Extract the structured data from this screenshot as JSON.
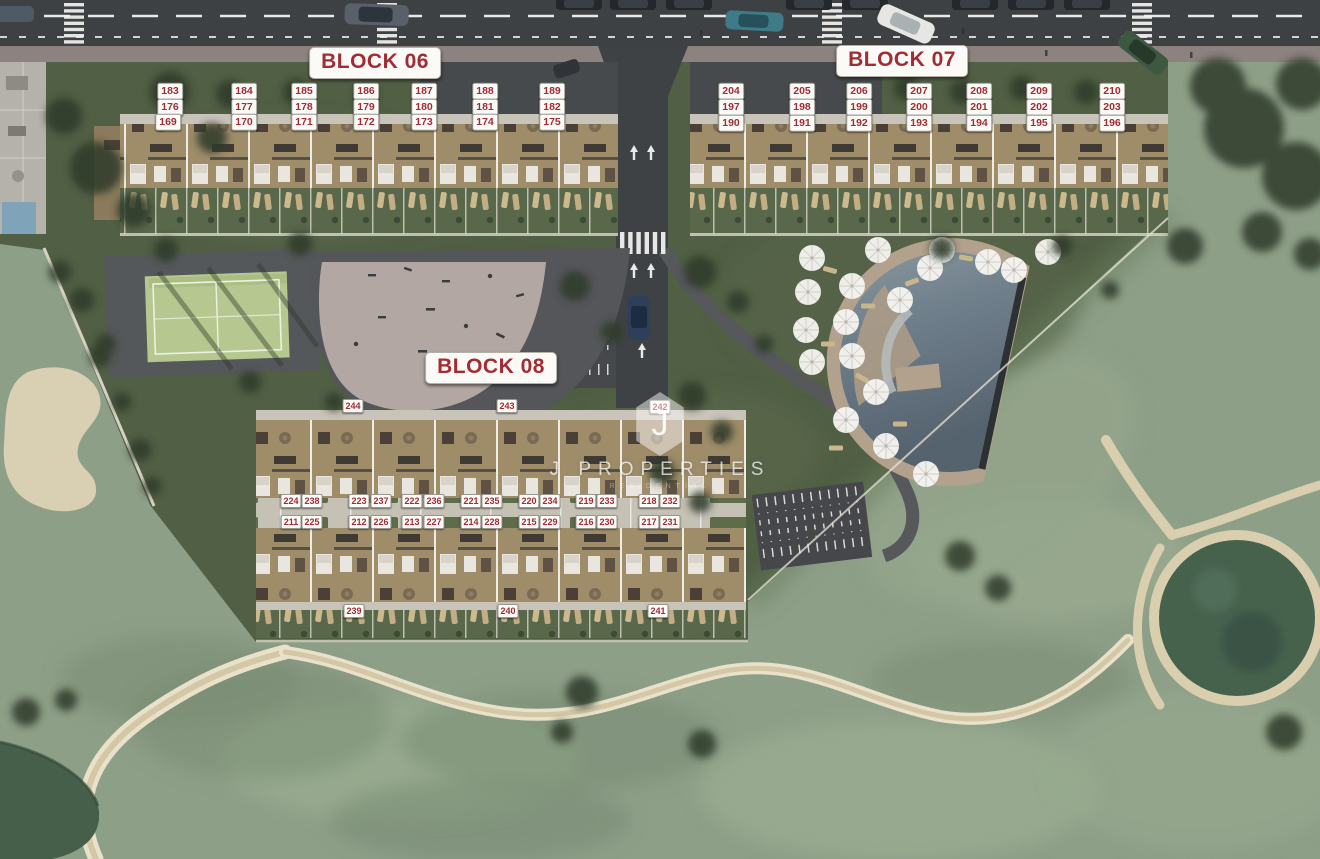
{
  "watermark": {
    "logo_letter": "J",
    "brand": "J PROPERTIES",
    "subtitle": "RESIDENTIAL"
  },
  "colors": {
    "label_red": "#A22C33",
    "label_bg": "#FCFBF8",
    "road_asphalt": "#3E4144",
    "development_green": "#515F44",
    "golf_green": "#8E9F88",
    "sand": "#D8CCAA",
    "pond_water": "#46624D",
    "pool_water": "#6E7E8A",
    "court_green": "#B6C890",
    "building_tan": "#A3906F",
    "walkway_gray": "#C9C4BA"
  },
  "map": {
    "block_labels": [
      {
        "id": "block-06",
        "text": "BLOCK 06",
        "x": 375,
        "y": 63
      },
      {
        "id": "block-07",
        "text": "BLOCK 07",
        "x": 902,
        "y": 61
      },
      {
        "id": "block-08",
        "text": "BLOCK 08",
        "x": 491,
        "y": 368
      }
    ],
    "unit_labels": [
      {
        "t": "183",
        "x": 170,
        "y": 91,
        "b": 6
      },
      {
        "t": "184",
        "x": 244,
        "y": 91,
        "b": 6
      },
      {
        "t": "185",
        "x": 304,
        "y": 91,
        "b": 6
      },
      {
        "t": "186",
        "x": 366,
        "y": 91,
        "b": 6
      },
      {
        "t": "187",
        "x": 424,
        "y": 91,
        "b": 6
      },
      {
        "t": "188",
        "x": 485,
        "y": 91,
        "b": 6
      },
      {
        "t": "189",
        "x": 552,
        "y": 91,
        "b": 6
      },
      {
        "t": "176",
        "x": 170,
        "y": 107,
        "b": 6
      },
      {
        "t": "177",
        "x": 244,
        "y": 107,
        "b": 6
      },
      {
        "t": "178",
        "x": 304,
        "y": 107,
        "b": 6
      },
      {
        "t": "179",
        "x": 366,
        "y": 107,
        "b": 6
      },
      {
        "t": "180",
        "x": 424,
        "y": 107,
        "b": 6
      },
      {
        "t": "181",
        "x": 485,
        "y": 107,
        "b": 6
      },
      {
        "t": "182",
        "x": 552,
        "y": 107,
        "b": 6
      },
      {
        "t": "169",
        "x": 168,
        "y": 122,
        "b": 6
      },
      {
        "t": "170",
        "x": 244,
        "y": 122,
        "b": 6
      },
      {
        "t": "171",
        "x": 304,
        "y": 122,
        "b": 6
      },
      {
        "t": "172",
        "x": 366,
        "y": 122,
        "b": 6
      },
      {
        "t": "173",
        "x": 424,
        "y": 122,
        "b": 6
      },
      {
        "t": "174",
        "x": 485,
        "y": 122,
        "b": 6
      },
      {
        "t": "175",
        "x": 552,
        "y": 122,
        "b": 6
      },
      {
        "t": "204",
        "x": 731,
        "y": 91,
        "b": 7
      },
      {
        "t": "205",
        "x": 802,
        "y": 91,
        "b": 7
      },
      {
        "t": "206",
        "x": 859,
        "y": 91,
        "b": 7
      },
      {
        "t": "207",
        "x": 919,
        "y": 91,
        "b": 7
      },
      {
        "t": "208",
        "x": 979,
        "y": 91,
        "b": 7
      },
      {
        "t": "209",
        "x": 1039,
        "y": 91,
        "b": 7
      },
      {
        "t": "210",
        "x": 1112,
        "y": 91,
        "b": 7
      },
      {
        "t": "197",
        "x": 731,
        "y": 107,
        "b": 7
      },
      {
        "t": "198",
        "x": 802,
        "y": 107,
        "b": 7
      },
      {
        "t": "199",
        "x": 859,
        "y": 107,
        "b": 7
      },
      {
        "t": "200",
        "x": 919,
        "y": 107,
        "b": 7
      },
      {
        "t": "201",
        "x": 979,
        "y": 107,
        "b": 7
      },
      {
        "t": "202",
        "x": 1039,
        "y": 107,
        "b": 7
      },
      {
        "t": "203",
        "x": 1112,
        "y": 107,
        "b": 7
      },
      {
        "t": "190",
        "x": 731,
        "y": 123,
        "b": 7
      },
      {
        "t": "191",
        "x": 802,
        "y": 123,
        "b": 7
      },
      {
        "t": "192",
        "x": 859,
        "y": 123,
        "b": 7
      },
      {
        "t": "193",
        "x": 919,
        "y": 123,
        "b": 7
      },
      {
        "t": "194",
        "x": 979,
        "y": 123,
        "b": 7
      },
      {
        "t": "195",
        "x": 1039,
        "y": 123,
        "b": 7
      },
      {
        "t": "196",
        "x": 1112,
        "y": 123,
        "b": 7
      },
      {
        "t": "244",
        "x": 353,
        "y": 406,
        "b": 8
      },
      {
        "t": "243",
        "x": 507,
        "y": 406,
        "b": 8
      },
      {
        "t": "242",
        "x": 660,
        "y": 407,
        "b": 8
      },
      {
        "t": "224",
        "x": 291,
        "y": 501,
        "b": 8
      },
      {
        "t": "238",
        "x": 312,
        "y": 501,
        "b": 8
      },
      {
        "t": "223",
        "x": 359,
        "y": 501,
        "b": 8
      },
      {
        "t": "237",
        "x": 381,
        "y": 501,
        "b": 8
      },
      {
        "t": "222",
        "x": 412,
        "y": 501,
        "b": 8
      },
      {
        "t": "236",
        "x": 434,
        "y": 501,
        "b": 8
      },
      {
        "t": "221",
        "x": 471,
        "y": 501,
        "b": 8
      },
      {
        "t": "235",
        "x": 492,
        "y": 501,
        "b": 8
      },
      {
        "t": "220",
        "x": 529,
        "y": 501,
        "b": 8
      },
      {
        "t": "234",
        "x": 550,
        "y": 501,
        "b": 8
      },
      {
        "t": "219",
        "x": 586,
        "y": 501,
        "b": 8
      },
      {
        "t": "233",
        "x": 607,
        "y": 501,
        "b": 8
      },
      {
        "t": "218",
        "x": 649,
        "y": 501,
        "b": 8
      },
      {
        "t": "232",
        "x": 670,
        "y": 501,
        "b": 8
      },
      {
        "t": "211",
        "x": 291,
        "y": 522,
        "b": 8
      },
      {
        "t": "225",
        "x": 312,
        "y": 522,
        "b": 8
      },
      {
        "t": "212",
        "x": 359,
        "y": 522,
        "b": 8
      },
      {
        "t": "226",
        "x": 381,
        "y": 522,
        "b": 8
      },
      {
        "t": "213",
        "x": 412,
        "y": 522,
        "b": 8
      },
      {
        "t": "227",
        "x": 434,
        "y": 522,
        "b": 8
      },
      {
        "t": "214",
        "x": 471,
        "y": 522,
        "b": 8
      },
      {
        "t": "228",
        "x": 492,
        "y": 522,
        "b": 8
      },
      {
        "t": "215",
        "x": 529,
        "y": 522,
        "b": 8
      },
      {
        "t": "229",
        "x": 550,
        "y": 522,
        "b": 8
      },
      {
        "t": "216",
        "x": 586,
        "y": 522,
        "b": 8
      },
      {
        "t": "230",
        "x": 607,
        "y": 522,
        "b": 8
      },
      {
        "t": "217",
        "x": 649,
        "y": 522,
        "b": 8
      },
      {
        "t": "231",
        "x": 670,
        "y": 522,
        "b": 8
      },
      {
        "t": "239",
        "x": 354,
        "y": 611,
        "b": 8
      },
      {
        "t": "240",
        "x": 508,
        "y": 611,
        "b": 8
      },
      {
        "t": "241",
        "x": 658,
        "y": 611,
        "b": 8
      }
    ]
  }
}
